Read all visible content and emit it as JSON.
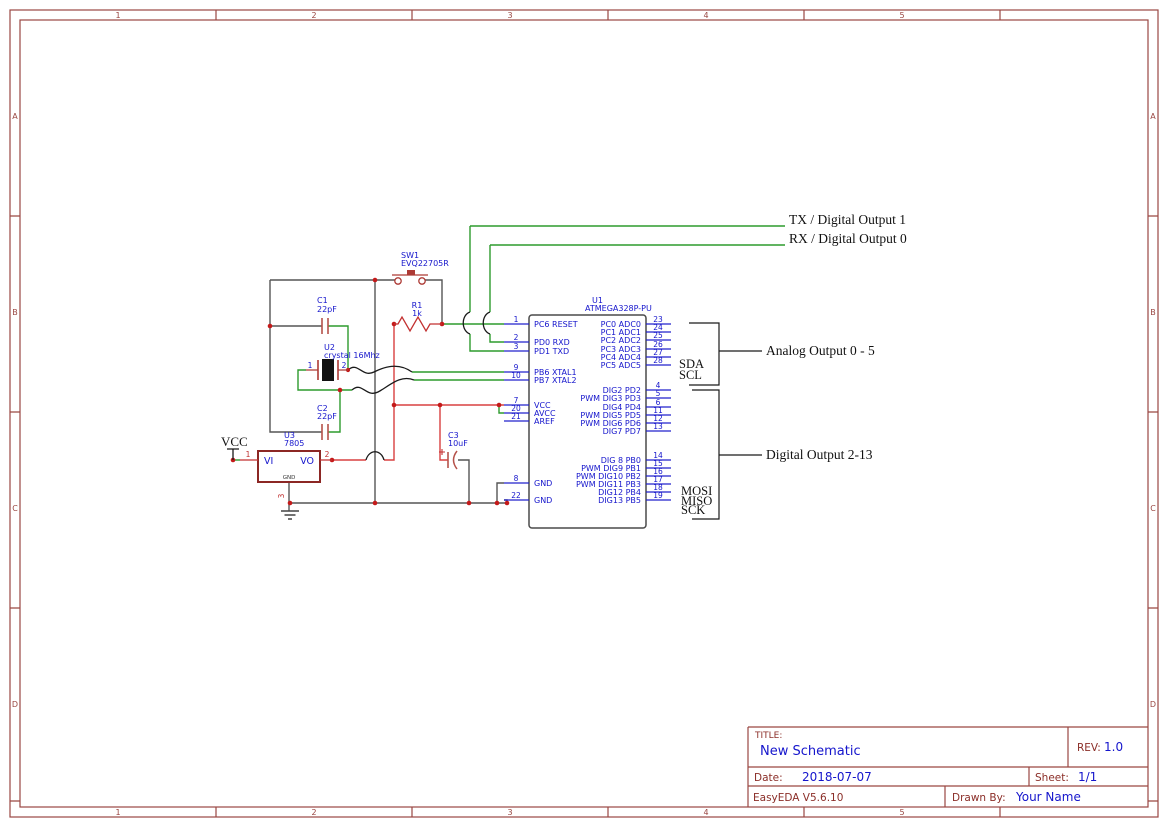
{
  "colors": {
    "frame": "#9a4742",
    "title_label_red": "#8b2e28",
    "schematic_blue": "#1515cc",
    "wire_green": "#2d9b2d",
    "power_red": "#d84040",
    "wire_gray": "#555555",
    "annotation_black": "#1a1a1a",
    "junction_red": "#c41a1a",
    "symbol_red": "#ad3a35",
    "regulator_maroon": "#8c2724",
    "cap_plate_red": "#b5524a"
  },
  "frame": {
    "top_numbers": [
      "1",
      "2",
      "3",
      "4",
      "5"
    ],
    "side_letters": [
      "A",
      "B",
      "C",
      "D"
    ]
  },
  "net_labels": {
    "tx": "TX / Digital Output 1",
    "rx": "RX / Digital Output 0",
    "analog": "Analog Output 0 - 5",
    "digital": "Digital Output 2-13",
    "sda": "SDA",
    "scl": "SCL",
    "mosi": "MOSI",
    "miso": "MISO",
    "sck": "SCK",
    "vcc": "VCC"
  },
  "u1": {
    "ref": "U1",
    "value": "ATMEGA328P-PU",
    "left_pins": [
      {
        "num": "1",
        "name": "PC6 RESET"
      },
      {
        "num": "2",
        "name": "PD0 RXD"
      },
      {
        "num": "3",
        "name": "PD1 TXD"
      },
      {
        "num": "9",
        "name": "PB6 XTAL1"
      },
      {
        "num": "10",
        "name": "PB7 XTAL2"
      },
      {
        "num": "7",
        "name": "VCC"
      },
      {
        "num": "20",
        "name": "AVCC"
      },
      {
        "num": "21",
        "name": "AREF"
      },
      {
        "num": "8",
        "name": "GND"
      },
      {
        "num": "22",
        "name": "GND"
      }
    ],
    "right_pins": [
      {
        "num": "23",
        "name": "PC0 ADC0"
      },
      {
        "num": "24",
        "name": "PC1 ADC1"
      },
      {
        "num": "25",
        "name": "PC2 ADC2"
      },
      {
        "num": "26",
        "name": "PC3 ADC3"
      },
      {
        "num": "27",
        "name": "PC4 ADC4"
      },
      {
        "num": "28",
        "name": "PC5 ADC5"
      },
      {
        "num": "4",
        "name": "DIG2 PD2"
      },
      {
        "num": "5",
        "name": "PWM DIG3 PD3"
      },
      {
        "num": "6",
        "name": "DIG4 PD4"
      },
      {
        "num": "11",
        "name": "PWM DIG5 PD5"
      },
      {
        "num": "12",
        "name": "PWM DIG6 PD6"
      },
      {
        "num": "13",
        "name": "DIG7 PD7"
      },
      {
        "num": "14",
        "name": "DIG 8 PB0"
      },
      {
        "num": "15",
        "name": "PWM DIG9 PB1"
      },
      {
        "num": "16",
        "name": "PWM DIG10 PB2"
      },
      {
        "num": "17",
        "name": "PWM DIG11 PB3"
      },
      {
        "num": "18",
        "name": "DIG12 PB4"
      },
      {
        "num": "19",
        "name": "DIG13 PB5"
      }
    ]
  },
  "sw1": {
    "ref": "SW1",
    "value": "EVQ22705R"
  },
  "r1": {
    "ref": "R1",
    "value": "1k"
  },
  "c1": {
    "ref": "C1",
    "value": "22pF"
  },
  "c2": {
    "ref": "C2",
    "value": "22pF"
  },
  "c3": {
    "ref": "C3",
    "value": "10uF"
  },
  "u2": {
    "ref": "U2",
    "value": "crystal 16Mhz",
    "pin1": "1",
    "pin2": "2"
  },
  "u3": {
    "ref": "U3",
    "value": "7805",
    "vi": "VI",
    "vo": "VO",
    "gnd": "GND",
    "pin1": "1",
    "pin2": "2",
    "pin3": "3"
  },
  "title_block": {
    "title_label": "TITLE:",
    "title": "New Schematic",
    "rev_label": "REV:",
    "rev": "1.0",
    "date_label": "Date:",
    "date": "2018-07-07",
    "sheet_label": "Sheet:",
    "sheet": "1/1",
    "software": "EasyEDA V5.6.10",
    "drawn_by_label": "Drawn By:",
    "drawn_by": "Your Name"
  }
}
